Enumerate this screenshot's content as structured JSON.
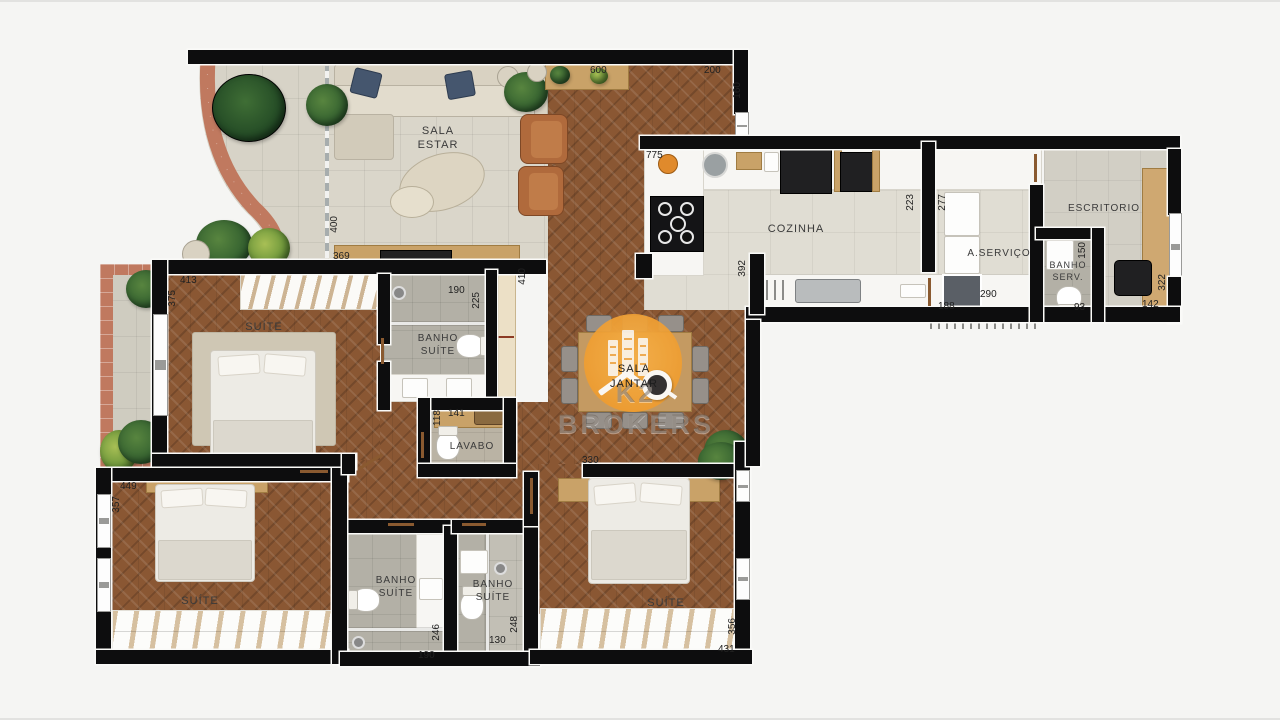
{
  "rooms": {
    "sala_estar": "SALA\nESTAR",
    "cozinha": "COZINHA",
    "a_servico": "A.SERVIÇO",
    "escritorio": "ESCRITORIO",
    "banho_serv": "BANHO\nSERV.",
    "suite_1": "SUÍTE",
    "banho_suite_1": "BANHO\nSUÍTE",
    "lavabo": "LAVABO",
    "sala_jantar": "SALA\nJANTAR",
    "suite_2": "SUÍTE",
    "banho_suite_2": "BANHO\nSUÍTE",
    "banho_suite_3": "BANHO\nSUÍTE",
    "suite_3": "SUÍTE"
  },
  "watermark": {
    "brand": "K2 BROKERS"
  },
  "dims": {
    "d600": "600",
    "d200": "200",
    "d160": "160",
    "d775": "775",
    "d369": "369",
    "d400": "400",
    "d413": "413",
    "d375": "375",
    "d190a": "190",
    "d225": "225",
    "d410": "410",
    "d141": "141",
    "d118": "118",
    "d223": "223",
    "d277": "277",
    "d290": "290",
    "d188": "188",
    "d392": "392",
    "d150": "150",
    "d93": "93",
    "d322": "322",
    "d142": "142",
    "d330": "330",
    "d449": "449",
    "d357": "357",
    "d190b": "190",
    "d246": "246",
    "d130": "130",
    "d248": "248",
    "d356": "356",
    "d431": "431"
  },
  "colors": {
    "accent_orange": "#F0A33C",
    "terracotta": "#C0795F",
    "wood": "#8A5A36",
    "wall": "#0D0D0E"
  }
}
